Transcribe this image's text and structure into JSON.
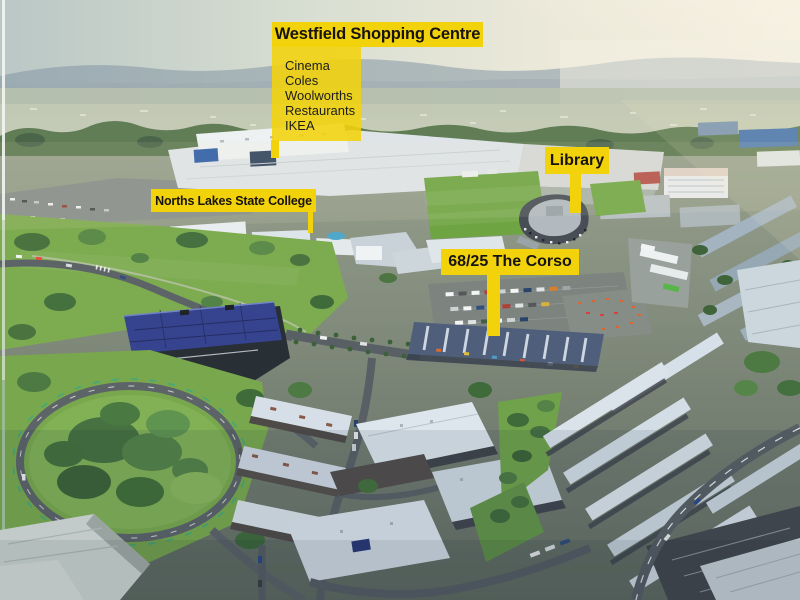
{
  "callouts": {
    "westfield": {
      "title": "Westfield Shopping Centre",
      "items": [
        "Cinema",
        "Coles",
        "Woolworths",
        "Restaurants",
        "IKEA"
      ]
    },
    "college": {
      "title": "Norths Lakes State College"
    },
    "library": {
      "title": "Library"
    },
    "property": {
      "title": "68/25 The Corso"
    }
  },
  "colors": {
    "callout_background": "#F2D30B",
    "callout_text": "#171310"
  }
}
